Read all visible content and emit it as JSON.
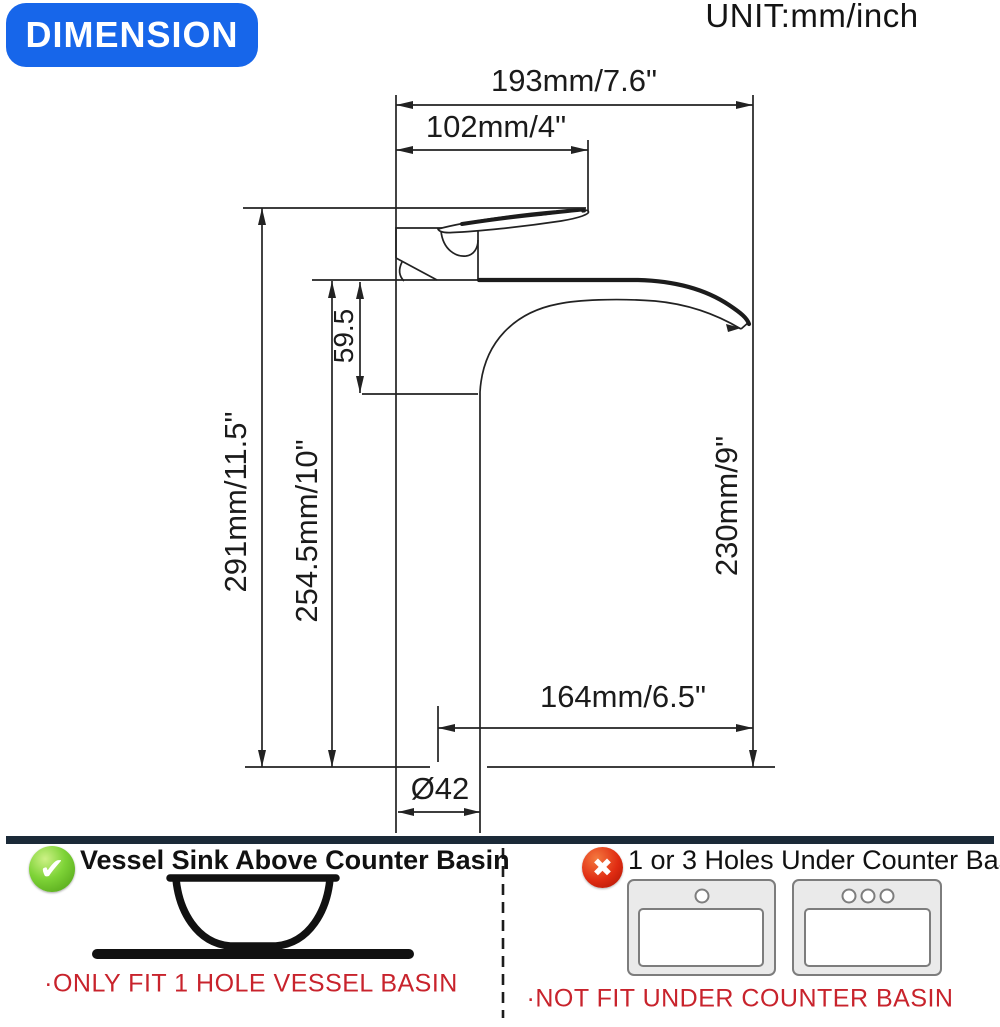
{
  "badge": {
    "label": "DIMENSION"
  },
  "unit_label": "UNIT:mm/inch",
  "diagram": {
    "type": "faucet-dimension-drawing",
    "dims": {
      "overall_width": "193mm/7.6\"",
      "handle_width": "102mm/4\"",
      "spout_drop": "59.5",
      "overall_height": "291mm/11.5\"",
      "height_to_spout_top": "254.5mm/10\"",
      "spout_outlet_height": "230mm/9\"",
      "spout_reach": "164mm/6.5\"",
      "base_diameter": "Ø42"
    }
  },
  "footer": {
    "left": {
      "icon": "check-icon",
      "icon_glyph": "✔",
      "title": "Vessel Sink Above Counter Basin",
      "note": "·ONLY FIT 1 HOLE VESSEL BASIN",
      "drawing": "vessel-bowl-on-counter"
    },
    "right": {
      "icon": "cross-icon",
      "icon_glyph": "✖",
      "title": "1 or 3 Holes Under Counter Basin",
      "note": "·NOT FIT UNDER COUNTER BASIN",
      "drawing": "one-hole-and-three-hole-under-counter-basins"
    }
  },
  "colors": {
    "badge_blue": "#1766ea",
    "line_black": "#222222",
    "note_red": "#c8232c",
    "divider_navy": "#1b2a38",
    "check_green": "#5cb320",
    "cross_red": "#d42414",
    "basin_gray": "#eaeaea"
  }
}
